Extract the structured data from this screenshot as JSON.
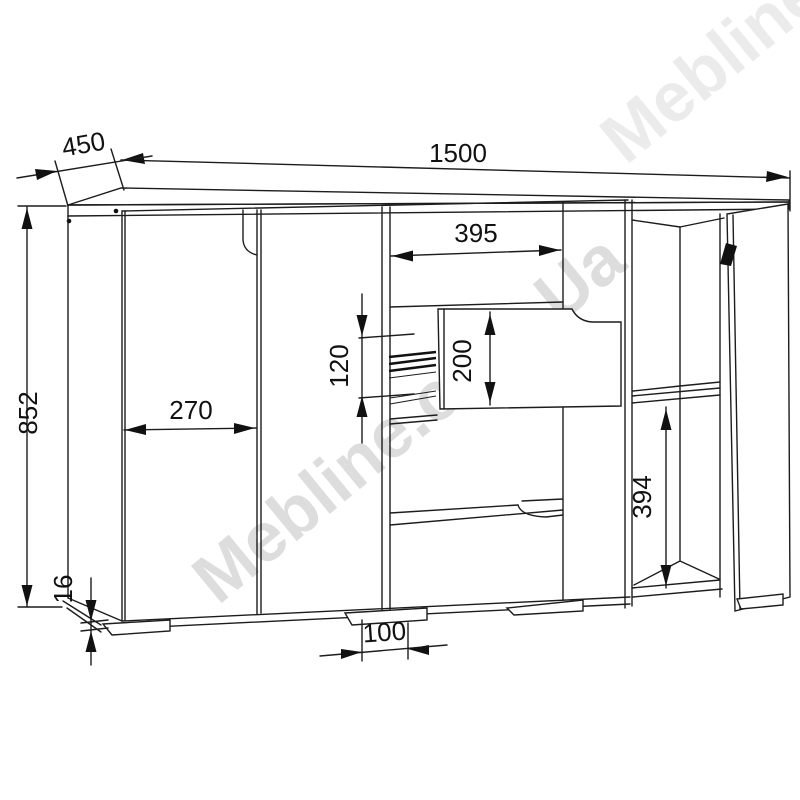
{
  "watermark": {
    "text": "Mebline.com.Ua"
  },
  "dimensions": {
    "width": "1500",
    "depth": "450",
    "height": "852",
    "left_door_width": "270",
    "drawer_opening_width": "395",
    "drawer_rail_spacing": "120",
    "drawer_front_height": "200",
    "shelf_compartment_height": "394",
    "foot_width": "100",
    "bottom_panel_thickness": "16"
  },
  "colors": {
    "line": "#1c1c1c",
    "watermark": "#c2c2c2",
    "background": "#ffffff"
  }
}
